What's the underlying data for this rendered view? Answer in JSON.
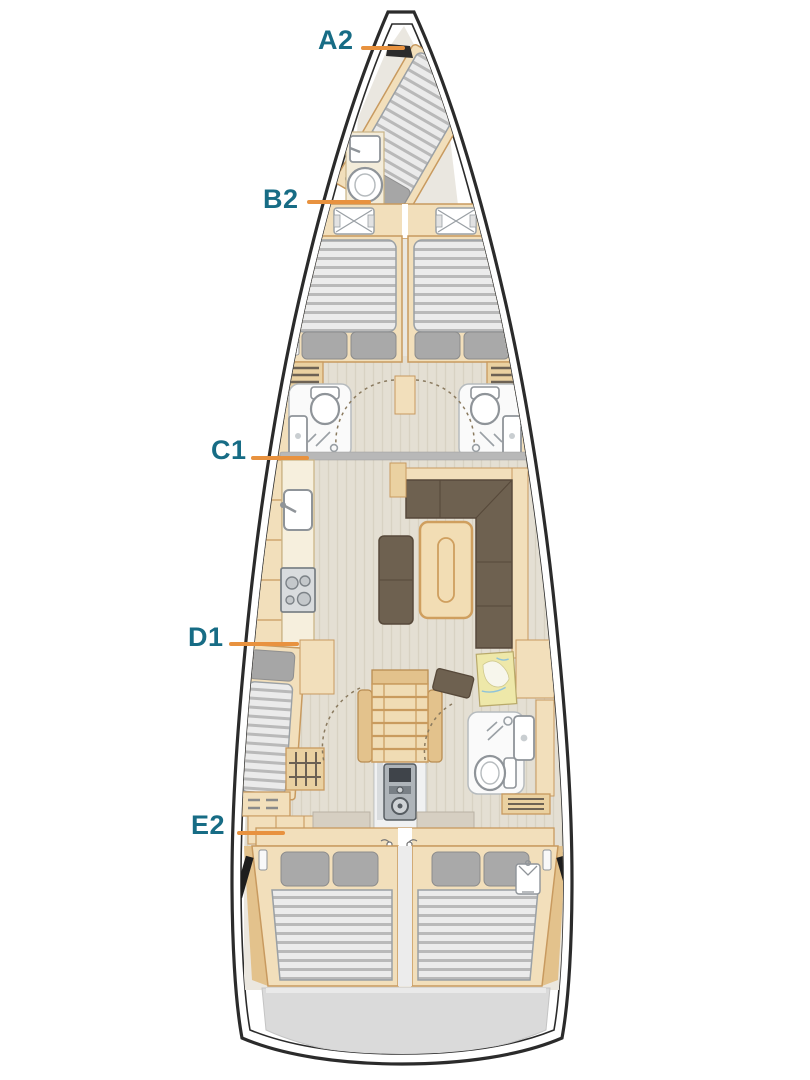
{
  "diagram": {
    "kind": "sailing-yacht-interior-deck-plan",
    "labels": [
      {
        "text": "A2"
      },
      {
        "text": "B2"
      },
      {
        "text": "C1"
      },
      {
        "text": "D1"
      },
      {
        "text": "E2"
      }
    ],
    "icons": [
      "deck-hatch-icon",
      "double-berth-icon",
      "single-berth-icon",
      "pillow-icon",
      "toilet-icon",
      "sink-icon",
      "shower-icon",
      "stove-icon",
      "galley-sink-icon",
      "saloon-sofa-icon",
      "saloon-table-icon",
      "bench-icon",
      "chart-table-icon",
      "navigator-seat-icon",
      "companionway-stairs-icon",
      "engine-icon",
      "hanging-locker-icon",
      "hull-window-icon",
      "stern-platform-icon"
    ],
    "colors": {
      "label_text": "#176c85",
      "leader_line": "#e8923f",
      "hull_outline": "#2b2b2b",
      "furniture_wood": "#f2dfbb",
      "wood_trim": "#c89a5f",
      "upholstery_brown": "#6e6150",
      "mattress_gray": "#b9b9b9",
      "fixture_white": "#ffffff",
      "floor_wood": "#e4dfd3",
      "stern_platform": "#dadada"
    }
  }
}
